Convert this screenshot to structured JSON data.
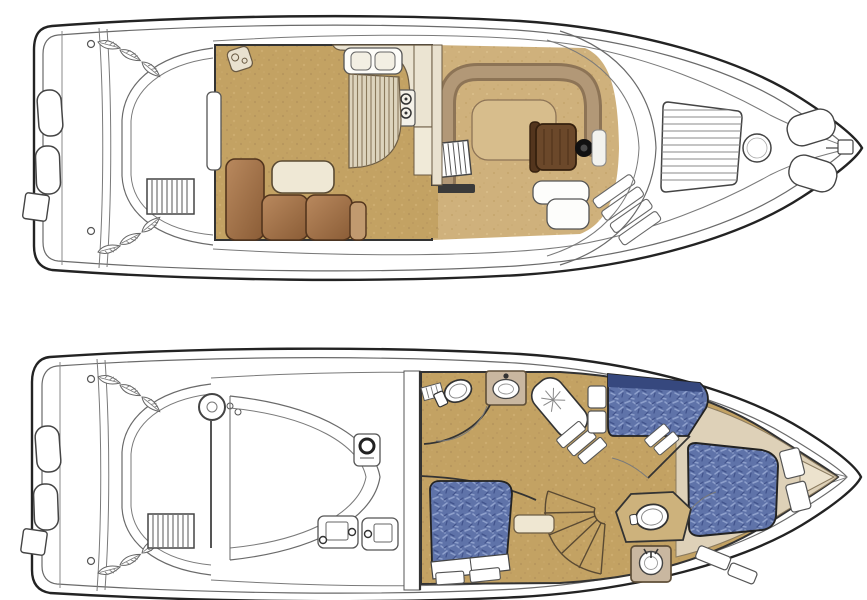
{
  "document": {
    "type": "yacht-deck-plans-scan",
    "background": "#ffffff",
    "visible_text": [],
    "plan_count": 2,
    "orientation": "bow-right"
  },
  "palette": {
    "outline": "#232323",
    "line_light": "#6a6a6a",
    "floor_tan": "#c3a263",
    "floor_tan_light": "#cfb17c",
    "upholstery_blue": "#5f73a9",
    "upholstery_blue_dark": "#36487e",
    "upholstery_blue_light": "#8ea0cc",
    "sofa_brown": "#9b6b45",
    "sofa_brown_dark": "#53351d",
    "furniture_cream": "#efe7d2",
    "counter_beige": "#ebe4d2",
    "vanity_taupe": "#c9b7a0",
    "bow_beige": "#ded1b8",
    "settee_band": "#8d7456",
    "helm_chair_brown": "#6b482a",
    "wheel_black": "#111111"
  },
  "decks": {
    "upper": {
      "label": "Main deck and flybridge plan, bow pointing right",
      "features": [
        "swim-platform",
        "transom-cushions",
        "boarding-notch",
        "cockpit-settee",
        "hatch-leaves",
        "cockpit-ladder",
        "salon",
        "salon-door",
        "speaker",
        "l-shaped-sofa",
        "coffee-table",
        "galley-counter",
        "double-sink",
        "stove",
        "galley-walkway",
        "dinette-settee",
        "dinette-table",
        "flybridge-stairs",
        "step-bar",
        "helm-chair",
        "steering-wheel",
        "helm-console",
        "side-steps",
        "windshield",
        "foredeck-sunpad",
        "deck-hatch",
        "bow-seat-cushions",
        "anchor-platform"
      ]
    },
    "lower": {
      "label": "Lower deck accommodations plan, bow pointing right",
      "features": [
        "swim-platform",
        "transom-cushions",
        "boarding-notch",
        "cockpit-settee",
        "hatch-leaves",
        "cockpit-ladder",
        "table-pedestal",
        "engine-hatch",
        "equipment-box",
        "battery-boxes",
        "bulkhead",
        "companionway",
        "aft-head-toilet",
        "aft-head-vanity",
        "louver-door",
        "shower-lounge",
        "stair-treads",
        "curved-staircase",
        "landing-step",
        "mid-cabin-berth",
        "mid-cabin-cabinets",
        "mid-cabin-steps",
        "aft-cabin-berth",
        "berth-pillows",
        "nightstands",
        "forward-berth",
        "berth-side-steps",
        "forward-head-toilet",
        "forward-head-sink",
        "bow-cabinetry",
        "chain-locker"
      ]
    }
  }
}
